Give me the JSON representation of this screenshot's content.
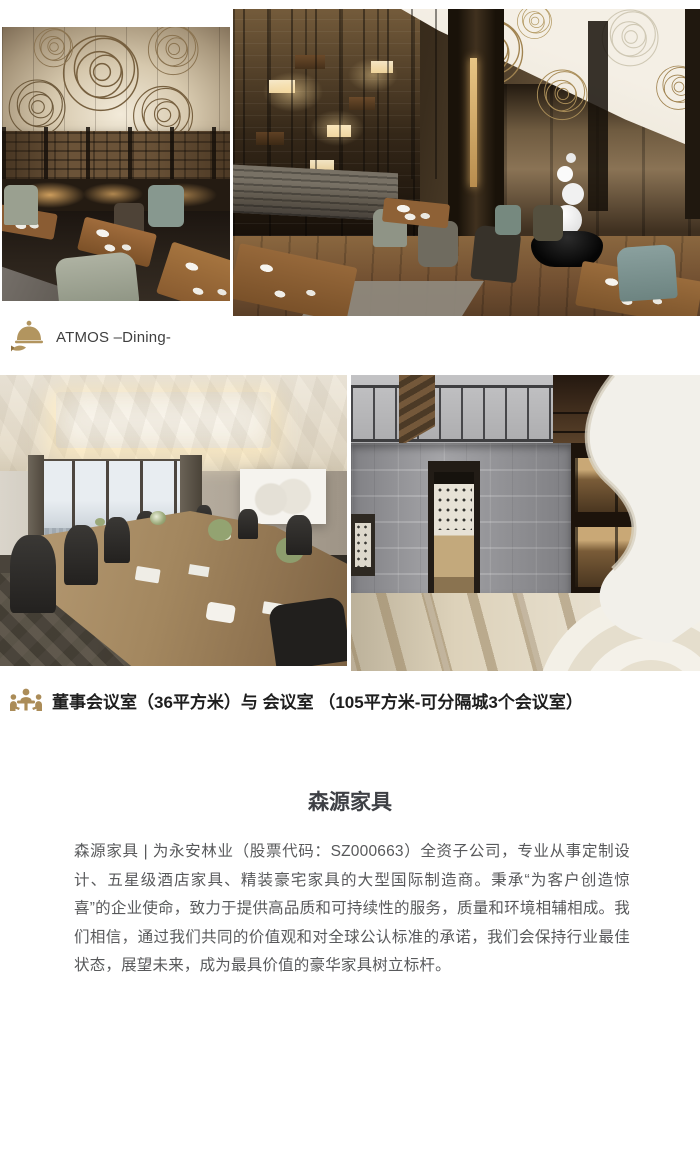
{
  "colors": {
    "page_background": "#ffffff",
    "accent_gold": "#b2955f",
    "caption_text": "#3f3f3f",
    "caption_bold_text": "#1e1e1e",
    "title_text": "#3e4045",
    "body_text": "#58595b"
  },
  "dining_section": {
    "icon": "cloche-serving-icon",
    "caption": "ATMOS –Dining-"
  },
  "meeting_section": {
    "icon": "meeting-people-icon",
    "caption": "董事会议室（36平方米）与 会议室 （105平方米-可分隔城3个会议室）"
  },
  "about_section": {
    "title": "森源家具",
    "paragraph": "森源家具 | 为永安林业（股票代码：SZ000663）全资子公司，专业从事定制设计、五星级酒店家具、精装豪宅家具的大型国际制造商。秉承“为客户创造惊喜”的企业使命，致力于提供高品质和可持续性的服务，质量和环境相辅相成。我们相信，通过我们共同的价值观和对全球公认标准的承诺，我们会保持行业最佳状态，展望未来，成为最具价值的豪华家具树立标杆。"
  }
}
